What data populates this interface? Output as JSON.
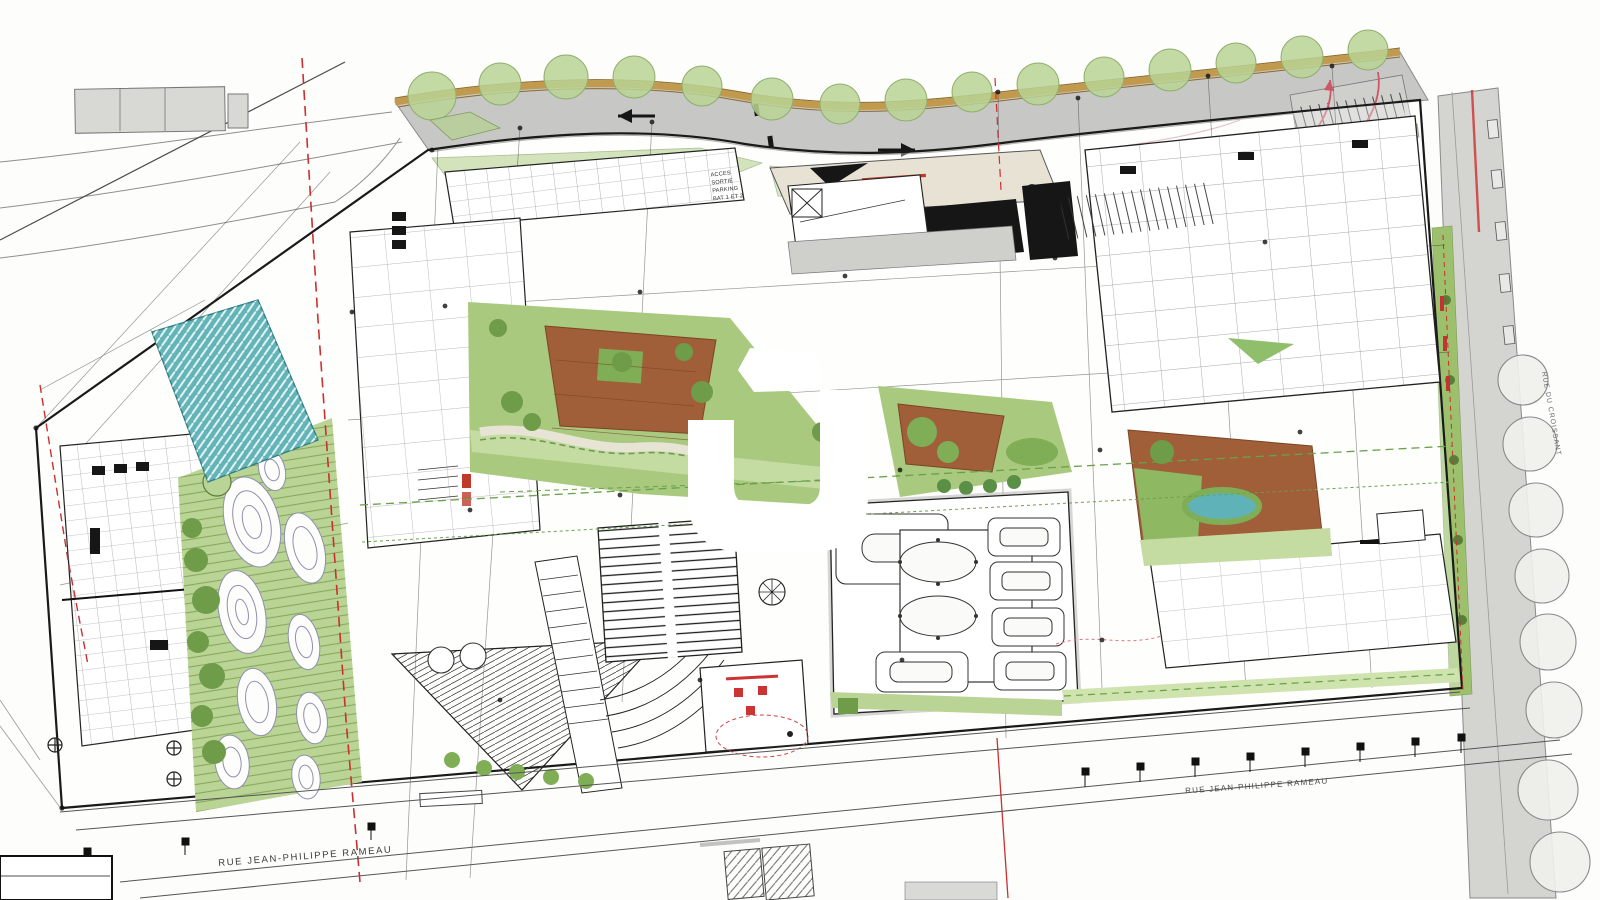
{
  "plan": {
    "kind": "architectural-site-plan",
    "streets": {
      "bottom_left": "RUE JEAN-PHILIPPE RAMEAU",
      "bottom_right": "RUE JEAN-PHILIPPE RAMEAU",
      "right_side": "RUE DU CROISSANT"
    },
    "annotations": {
      "parking_access": [
        "ACCES",
        "SORTIE",
        "PARKING",
        "BAT 1 ET 2"
      ]
    },
    "watermark": "logo-watermark",
    "palette": {
      "road_grey": "#c7c7c5",
      "sidewalk_beige": "#e7e2d4",
      "tree_green": "#b9d494",
      "garden_green": "#a9c97e",
      "shrub_green": "#6f9c49",
      "terrace_brown": "#a05f38",
      "water_teal": "#62b4b8",
      "boundary_red": "#cc2f2f",
      "utility_green": "#69a14a",
      "ochre_edge": "#c19a4e",
      "roof_black": "#161616"
    }
  }
}
